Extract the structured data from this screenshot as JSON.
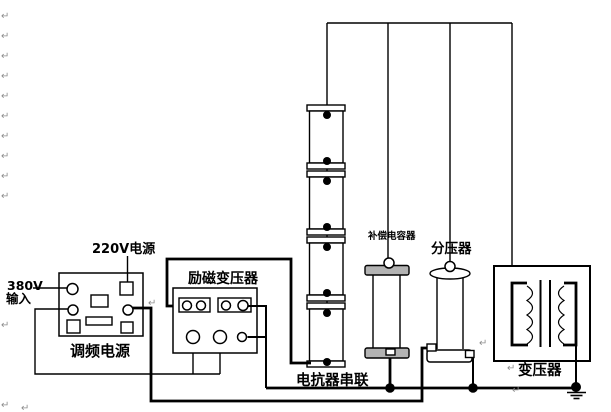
{
  "diagram": {
    "title_hint": "high-voltage series-resonant test circuit diagram",
    "labels": {
      "input_380v_line1": "380V",
      "input_380v_line2": "输入",
      "freq_power_supply": "调频电源",
      "power_220v": "220V电源",
      "excitation_transformer": "励磁变压器",
      "reactor_series": "电抗器串联",
      "compensation_capacitor": "补偿电容器",
      "voltage_divider": "分压器",
      "transformer": "变压器"
    },
    "marks": {
      "return_glyph": "↵"
    },
    "colors": {
      "line": "#000000",
      "background": "#ffffff",
      "return_mark": "#8e8e8e",
      "plate_fill": "#b3b3b3"
    }
  }
}
